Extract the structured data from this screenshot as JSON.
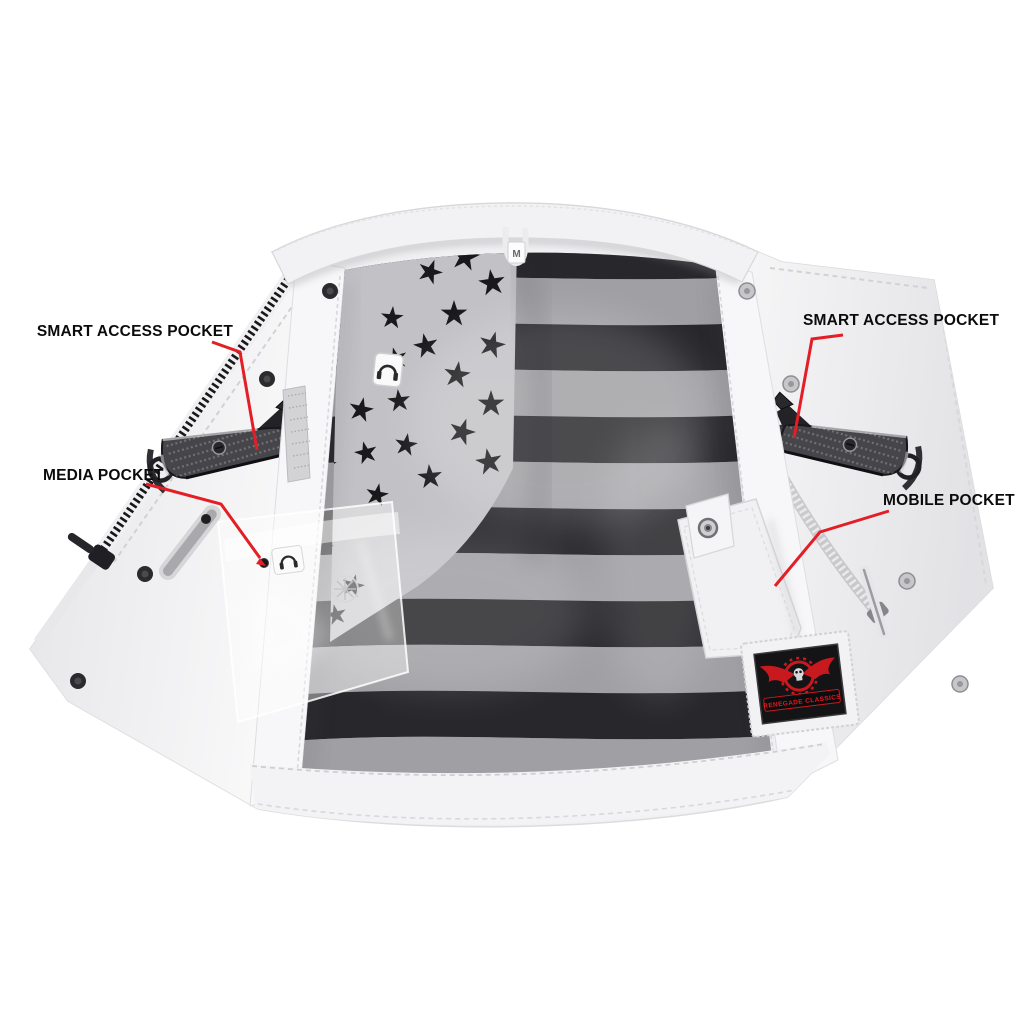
{
  "page": {
    "background": "#ffffff",
    "description": "Open white leather club vest showing black-and-white American flag interior lining, with red callout lines labeling interior pockets"
  },
  "annotations": {
    "smart_access_left": {
      "label": "SMART ACCESS POCKET"
    },
    "media": {
      "label": "MEDIA POCKET"
    },
    "smart_access_right": {
      "label": "SMART ACCESS POCKET"
    },
    "mobile": {
      "label": "MOBILE POCKET"
    }
  },
  "tags": {
    "collar_size_tag": "M",
    "brand_patch_text": "RENEGADE CLASSICS"
  },
  "icons": [
    "headphones-icon",
    "snap-button-icon",
    "wheel-emblem-icon",
    "winged-skull-logo"
  ],
  "colors": {
    "callout_line": "#e41e26",
    "label_text": "#0b0b0b",
    "patch_red": "#c8191f",
    "stripe_dark": "#28282c",
    "stripe_light": "#a0a0a4",
    "leather_white": "#f1f1f3"
  }
}
